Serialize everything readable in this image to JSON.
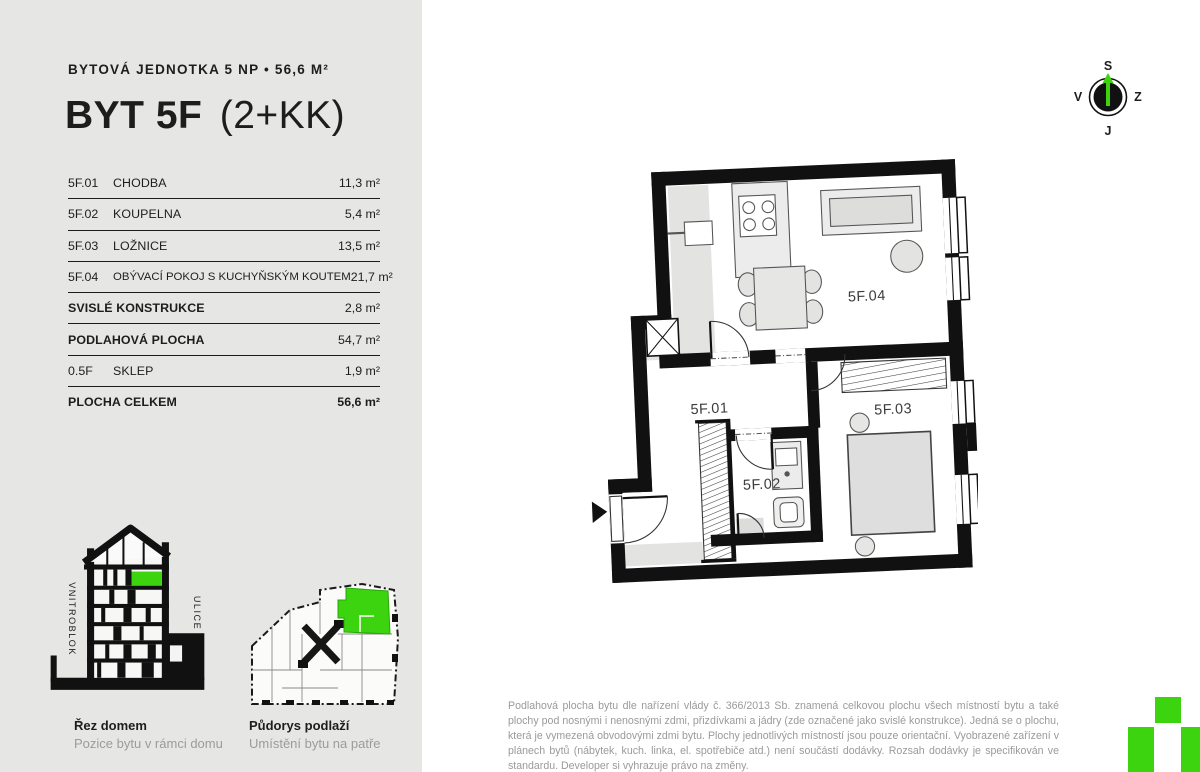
{
  "colors": {
    "panel_background": "#e6e7e5",
    "accent_green": "#3bd40f",
    "wall_black": "#111111",
    "text_dark": "#1d1e1c",
    "text_gray": "#9a9a9a",
    "furniture_gray": "#e3e3e2"
  },
  "header": {
    "subtitle": "BYTOVÁ JEDNOTKA 5 NP • 56,6 M²",
    "title_main": "BYT 5F",
    "title_suffix": "(2+KK)"
  },
  "table": {
    "rows": [
      {
        "code": "5F.01",
        "name": "CHODBA",
        "value": "11,3 m²"
      },
      {
        "code": "5F.02",
        "name": "KOUPELNA",
        "value": "5,4 m²"
      },
      {
        "code": "5F.03",
        "name": "LOŽNICE",
        "value": "13,5 m²"
      },
      {
        "code": "5F.04",
        "name": "OBÝVACÍ POKOJ S KUCHYŇSKÝM KOUTEM",
        "value": "21,7 m²"
      },
      {
        "code": "",
        "name": "SVISLÉ KONSTRUKCE",
        "value": "2,8 m²"
      },
      {
        "code": "",
        "name": "PODLAHOVÁ PLOCHA",
        "value": "54,7 m²"
      },
      {
        "code": "0.5F",
        "name": "SKLEP",
        "value": "1,9 m²"
      },
      {
        "code": "",
        "name": "PLOCHA CELKEM",
        "value": "56,6 m²"
      }
    ]
  },
  "section_diagram": {
    "title": "Řez domem",
    "subtitle": "Pozice bytu v rámci domu",
    "label_left": "VNITROBLOK",
    "label_right": "ULICE"
  },
  "floor_key": {
    "title": "Půdorys podlaží",
    "subtitle": "Umístění bytu na patře"
  },
  "compass": {
    "top": "S",
    "left": "V",
    "right": "Z",
    "bottom": "J"
  },
  "plan": {
    "rooms": [
      "5F.01",
      "5F.02",
      "5F.03",
      "5F.04"
    ]
  },
  "disclaimer": "Podlahová plocha bytu dle nařízení vlády č. 366/2013 Sb. znamená celkovou plochu všech místností bytu a také plochy pod nosnými i nenosnými zdmi, přizdívkami a jádry (zde označené jako svislé konstrukce). Jedná se o plochu, která je vymezená obvodovými zdmi bytu. Plochy jednotlivých místností jsou pouze orientační. Vyobrazené zařízení v plánech bytů (nábytek, kuch. linka, el. spotřebiče atd.) není součástí dodávky. Rozsah dodávky je specifikován ve standardu. Developer si vyhrazuje právo na změny."
}
